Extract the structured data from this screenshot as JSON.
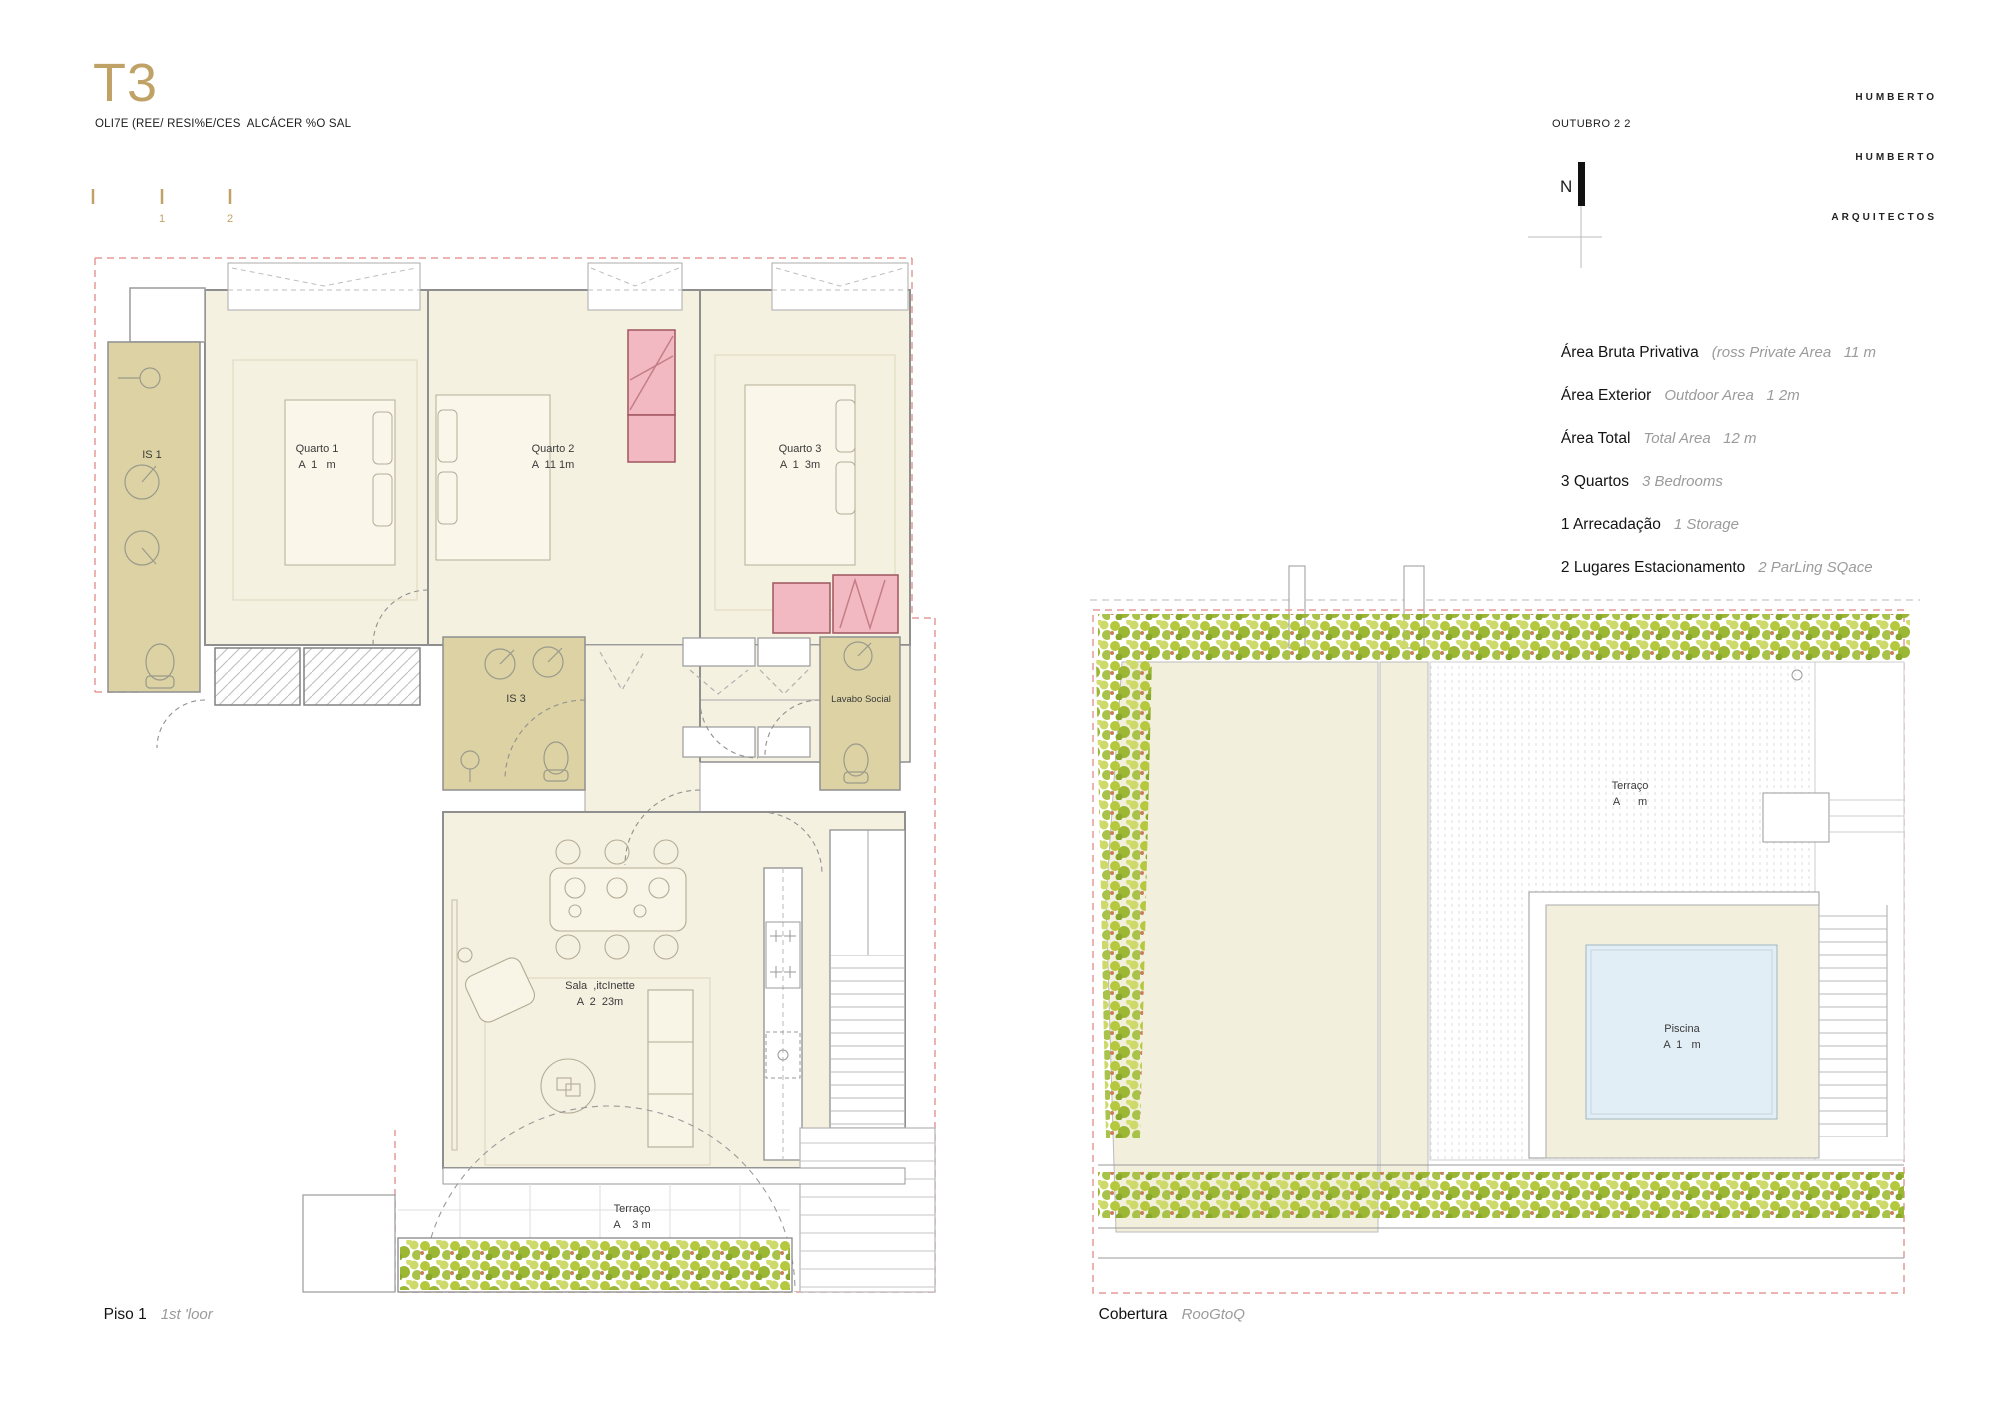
{
  "header": {
    "title": "T3",
    "subtitle": "OLI7E (REE/ RESI%E/CES  ALCÁCER %O SAL",
    "scale": {
      "tick1": "1",
      "tick2": "2"
    }
  },
  "firm": {
    "line1": "HUMBERTO",
    "line2": "HUMBERTO",
    "line3": "ARQUITECTOS",
    "date": "OUTUBRO 2 2",
    "north_label": "N"
  },
  "specs": [
    {
      "label": "Área Bruta Privativa",
      "note": "(ross Private Area   11 m"
    },
    {
      "label": "Área Exterior",
      "note": "Outdoor Area   1 2m"
    },
    {
      "label": "Área Total",
      "note": "Total Area   12 m"
    },
    {
      "label": "3 Quartos",
      "note": "3 Bedrooms"
    },
    {
      "label": "1 Arrecadação",
      "note": "1 Storage"
    },
    {
      "label": "2 Lugares Estacionamento",
      "note": "2 ParLing SQace"
    }
  ],
  "floor_plan": {
    "caption": "Piso 1",
    "caption_note": "1st 'loor",
    "rooms": {
      "is1": {
        "name": "IS 1"
      },
      "quarto1": {
        "name": "Quarto 1",
        "area": "A  1   m"
      },
      "quarto2": {
        "name": "Quarto 2",
        "area": "A  11 1m"
      },
      "quarto3": {
        "name": "Quarto 3",
        "area": "A  1  3m"
      },
      "is3": {
        "name": "IS 3"
      },
      "lavabo": {
        "name": "Lavabo Social"
      },
      "sala": {
        "name": "Sala  ,itcInette",
        "area": "A  2  23m"
      },
      "terraco": {
        "name": "Terraço",
        "area": "A    3 m"
      }
    }
  },
  "roof_plan": {
    "caption": "Cobertura",
    "caption_note": "RooGtoQ",
    "rooms": {
      "terraco": {
        "name": "Terraço",
        "area": "A      m"
      },
      "piscina": {
        "name": "Piscina",
        "area": "A  1   m"
      }
    }
  },
  "colors": {
    "accent_gold": "#c1a266",
    "room_cream": "#f5f1e1",
    "bath_tan": "#ddd2a4",
    "wardrobe_pink": "#f2b9c2",
    "pool_blue": "#e2eef5",
    "hedge_green": "#b5c83e",
    "boundary_red": "#e59a9a",
    "note_gray": "#9b9b9b"
  }
}
